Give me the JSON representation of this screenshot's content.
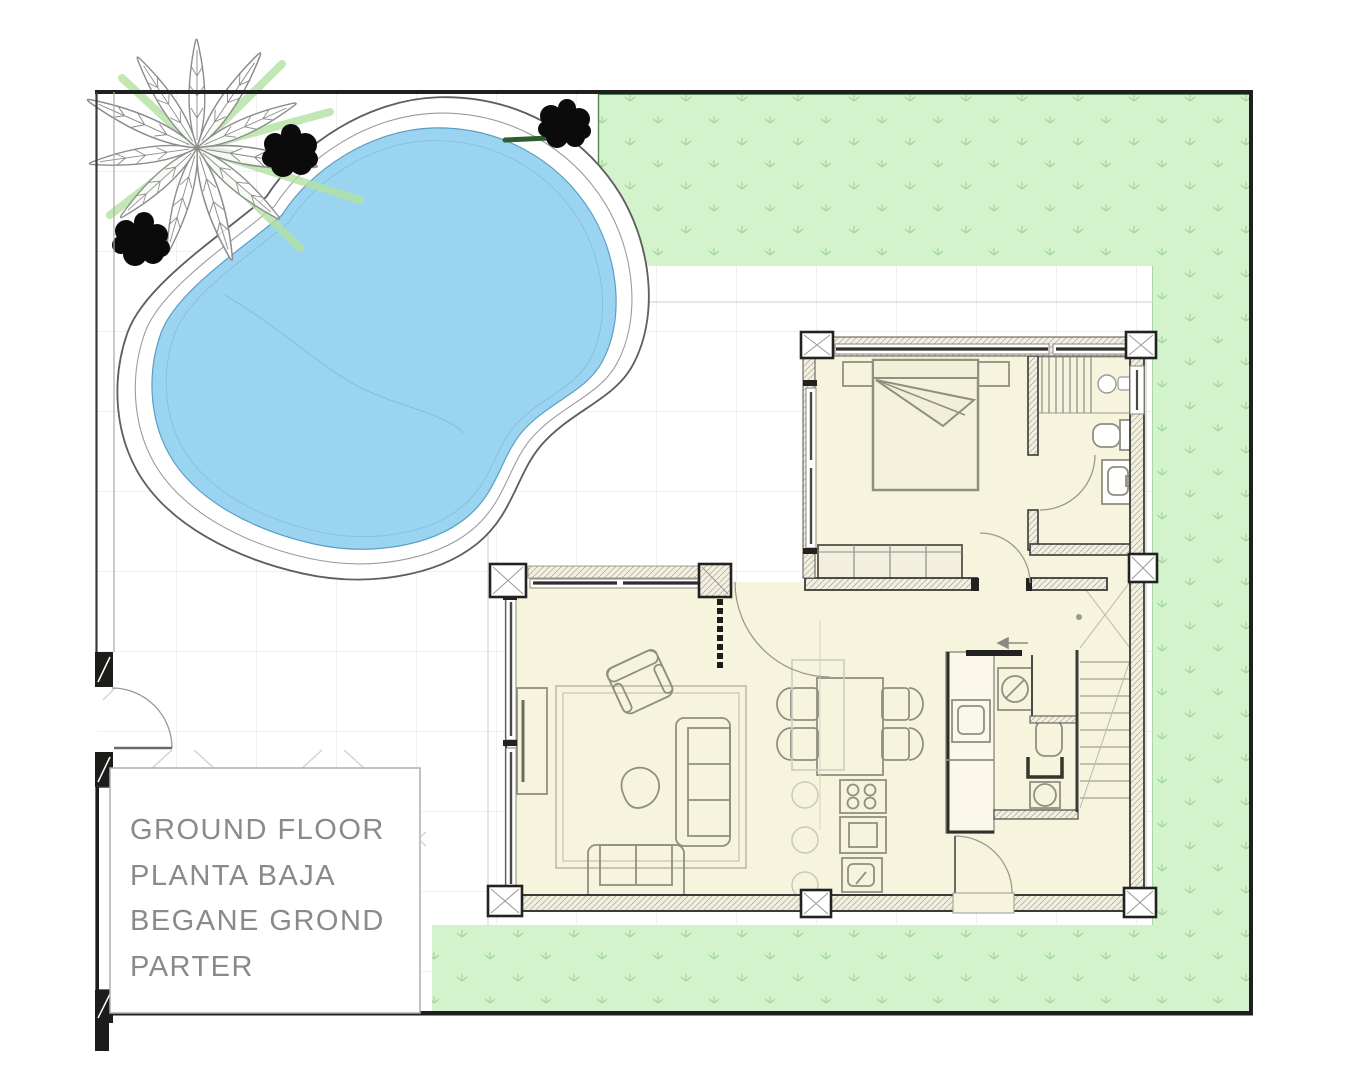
{
  "title_block": {
    "lines": [
      "GROUND FLOOR",
      "PLANTA BAJA",
      "BEGANE GROND",
      "PARTER"
    ]
  },
  "palette": {
    "pool_water": "#9bd4f1",
    "pool_water_edge": "#5b9ec4",
    "deck_line": "#5f5f5f",
    "grass_fill": "#d2f3cb",
    "grass_mark": "#9ad595",
    "grass_dark_edge": "#2e5c2e",
    "floor_fill": "#f7f4dd",
    "wall_dark": "#3a3a38",
    "hatch_line": "#a9a796",
    "tile_line": "#e2e2e2",
    "furniture_line": "#8f8f82",
    "ghost_line": "#c9c9c0",
    "plant_black": "#0b0b0b",
    "palm_gray": "#8c8c8c",
    "palm_green": "#b2e2a2",
    "palm_green_dark": "#2d5f2d",
    "boundary_dark": "#1f1f1f",
    "text_color": "#8a8a8a",
    "title_box_border": "#adadad"
  }
}
